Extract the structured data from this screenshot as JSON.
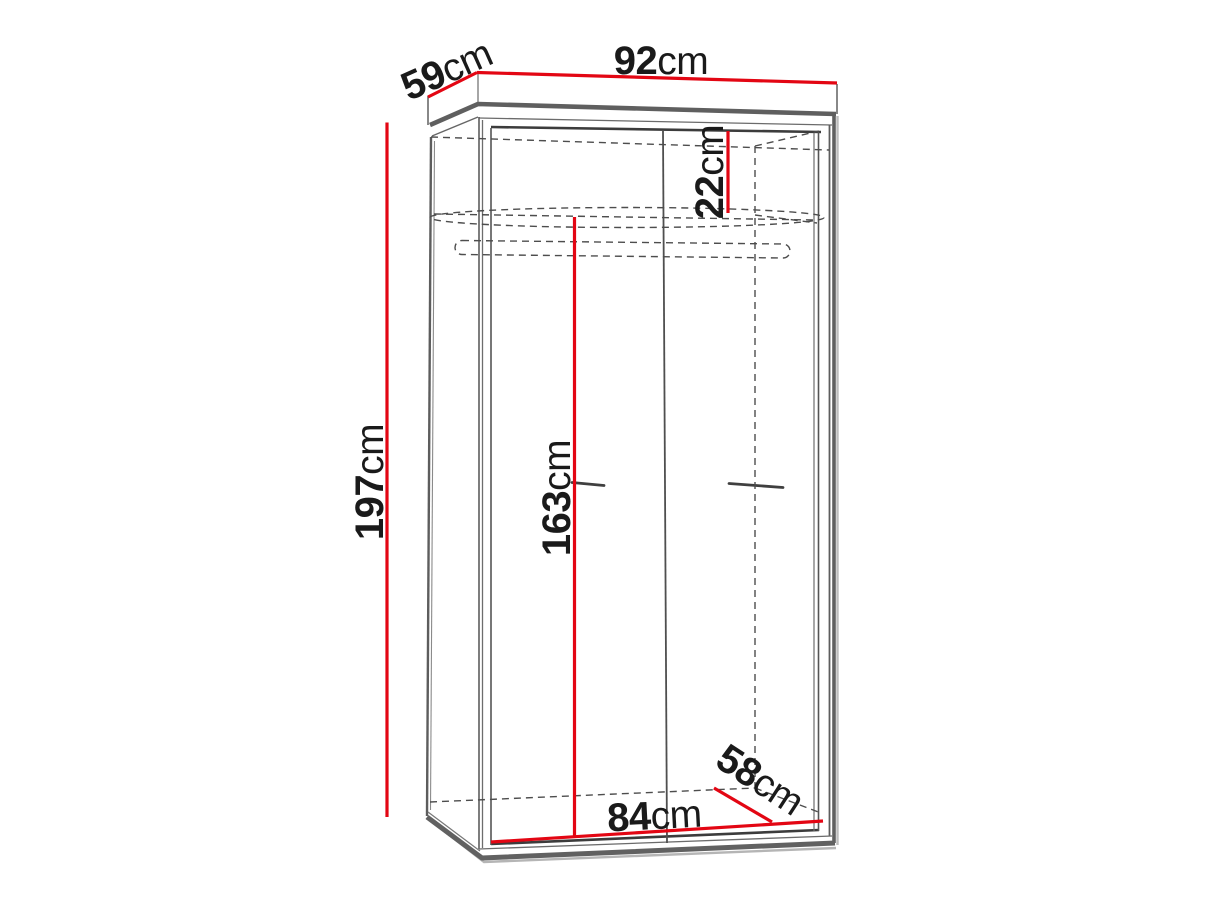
{
  "diagram": {
    "subject": "two-door wardrobe dimension drawing",
    "accent_color": "#e30613",
    "outline_color": "#5a5a5a",
    "hidden_line_color": "#4d4d4d",
    "text_color": "#1a1a1a",
    "dimensions": {
      "top_width": {
        "value": "92",
        "unit": "cm"
      },
      "top_depth": {
        "value": "59",
        "unit": "cm"
      },
      "height": {
        "value": "197",
        "unit": "cm"
      },
      "top_section_height": {
        "value": "22",
        "unit": "cm"
      },
      "interior_height": {
        "value": "163",
        "unit": "cm"
      },
      "interior_width": {
        "value": "84",
        "unit": "cm"
      },
      "interior_depth": {
        "value": "58",
        "unit": "cm"
      }
    }
  }
}
